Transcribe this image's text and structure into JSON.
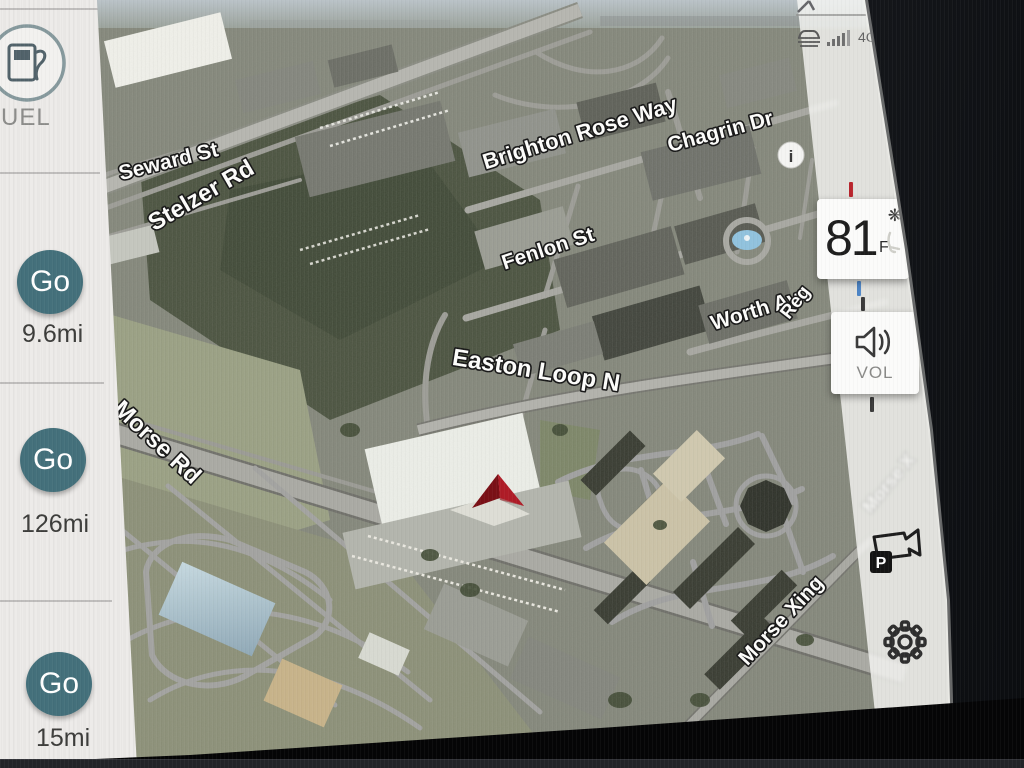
{
  "sidebar": {
    "fuel_label": "UEL",
    "shortcuts": [
      {
        "label": "Go",
        "distance": "9.6mi"
      },
      {
        "label": "Go",
        "distance": "126mi"
      },
      {
        "label": "Go",
        "distance": "15mi"
      }
    ]
  },
  "status": {
    "network": "4G"
  },
  "climate": {
    "temp": "81",
    "unit": "F"
  },
  "volume": {
    "label": "VOL"
  },
  "camera": {
    "badge": "P"
  },
  "map": {
    "info": "i",
    "labels": {
      "seward": "Seward St",
      "stelzer": "Stelzer Rd",
      "brighton": "Brighton Rose Way",
      "chagrin": "Chagrin Dr",
      "fenlon": "Fenlon St",
      "worth": "Worth Av",
      "reg": "Reg",
      "easton": "Easton Loop N",
      "morse_rd": "Morse Rd",
      "morse_xing": "Morse Xing",
      "morse_partial": "Morse X"
    }
  },
  "icons": {
    "sidebar": [
      "fuel-pump-icon"
    ],
    "status": [
      "connected-car-icon",
      "signal-bars-icon"
    ],
    "climate": [
      "fan-icon",
      "seat-icon"
    ],
    "right_rail": [
      "speaker-icon",
      "parking-camera-icon",
      "gear-icon"
    ],
    "map": [
      "info-icon",
      "nav-arrow-icon"
    ]
  },
  "colors": {
    "accent_teal": "#44707b",
    "temp_hot_tick": "#b9262e",
    "temp_cold_tick": "#4d85c6",
    "nav_arrow_red": "#c32430"
  }
}
